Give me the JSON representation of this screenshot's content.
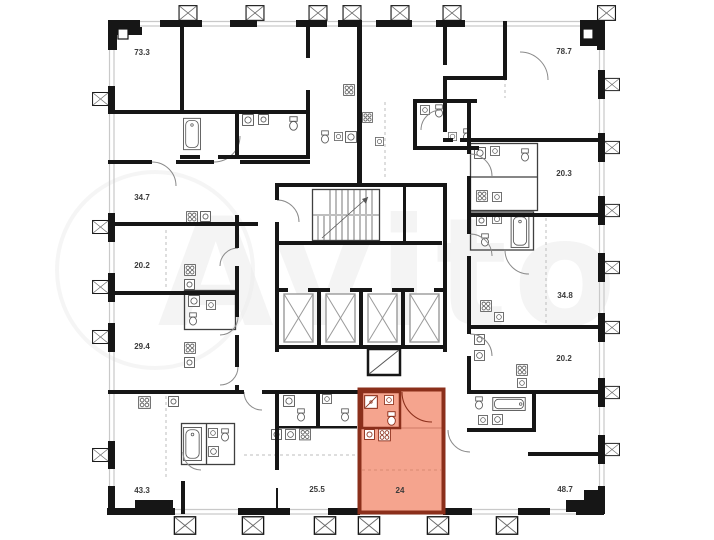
{
  "watermark": {
    "text": "Avito"
  },
  "plan": {
    "area_labels": [
      {
        "label": "73.3",
        "x": 142,
        "y": 55,
        "highlighted": false
      },
      {
        "label": "34.7",
        "x": 142,
        "y": 200,
        "highlighted": false
      },
      {
        "label": "20.2",
        "x": 142,
        "y": 268,
        "highlighted": false
      },
      {
        "label": "29.4",
        "x": 142,
        "y": 349,
        "highlighted": false
      },
      {
        "label": "43.3",
        "x": 142,
        "y": 493,
        "highlighted": false
      },
      {
        "label": "25.5",
        "x": 317,
        "y": 492,
        "highlighted": false
      },
      {
        "label": "24",
        "x": 400,
        "y": 493,
        "highlighted": true
      },
      {
        "label": "48.7",
        "x": 565,
        "y": 492,
        "highlighted": false
      },
      {
        "label": "20.2",
        "x": 564,
        "y": 361,
        "highlighted": false
      },
      {
        "label": "34.8",
        "x": 565,
        "y": 298,
        "highlighted": false
      },
      {
        "label": "20.3",
        "x": 564,
        "y": 176,
        "highlighted": false
      },
      {
        "label": "78.7",
        "x": 564,
        "y": 54,
        "highlighted": false
      }
    ],
    "highlighted_unit": {
      "label": "24",
      "fill": "#f5a48e",
      "border": "#8b2f1b"
    },
    "core": {
      "elevator_count": 4,
      "has_staircase": true
    }
  },
  "colors": {
    "wall": "#161616",
    "fixture": "#555555",
    "window": "#c9c9c9",
    "label": "#3b3b3b",
    "watermark": "#ececec"
  }
}
